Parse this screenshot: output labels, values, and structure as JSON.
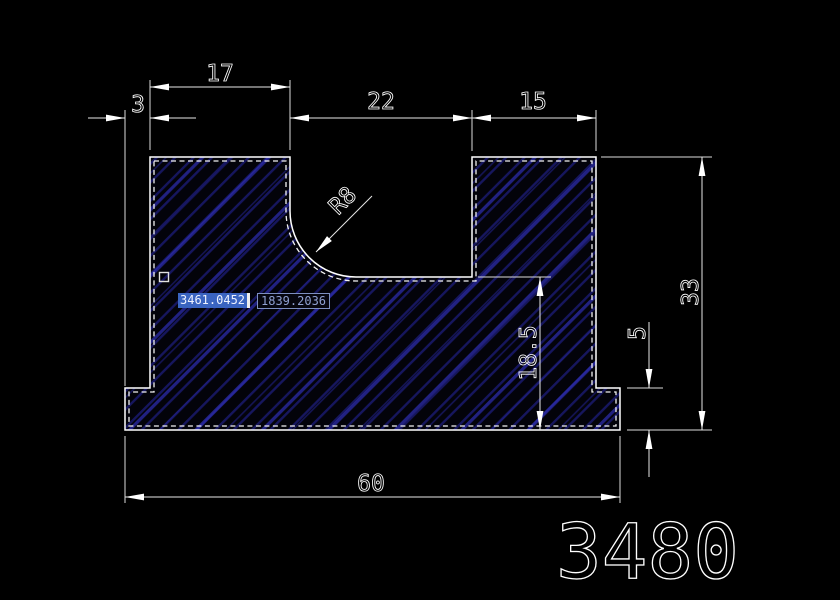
{
  "view": {
    "background": "#000000",
    "app_hint": "cad-model-space"
  },
  "drawing": {
    "drawing_number": "3480",
    "line_color": "#ffffff",
    "hatch_line_color": "#16165e",
    "hatch_accent_color": "#2d2db4",
    "dimensions": {
      "d17": "17",
      "d3": "3",
      "d22": "22",
      "d15": "15",
      "r8": "R8",
      "d33": "33",
      "d5": "5",
      "d18_5": "18.5",
      "d60": "60"
    }
  },
  "dynamic_input": {
    "x_field": {
      "value": "3461.0452",
      "selected": true
    },
    "y_field": {
      "value": "1839.2036",
      "selected": false
    }
  }
}
